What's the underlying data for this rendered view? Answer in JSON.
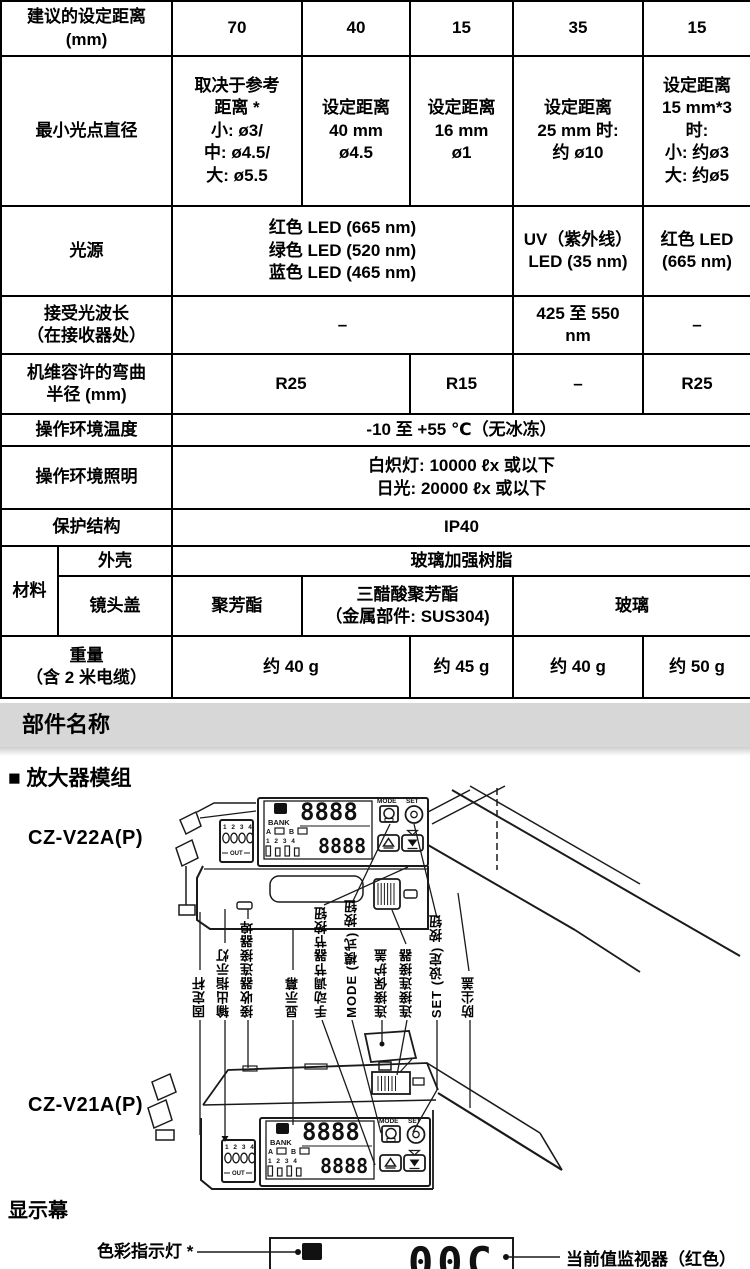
{
  "spec_table": {
    "rows": [
      {
        "cells": [
          {
            "t": "建议的设定距离\n(mm)"
          },
          {
            "t": "70"
          },
          {
            "t": "40"
          },
          {
            "t": "15"
          },
          {
            "t": "35"
          },
          {
            "t": "15"
          }
        ]
      },
      {
        "cells": [
          {
            "t": "最小光点直径"
          },
          {
            "t": "取决于参考\n距离 *\n小: ø3/\n中: ø4.5/\n大: ø5.5"
          },
          {
            "t": "设定距离\n40 mm\nø4.5"
          },
          {
            "t": "设定距离\n16 mm\nø1"
          },
          {
            "t": "设定距离\n25 mm 时:\n约 ø10"
          },
          {
            "t": "设定距离\n15 mm*3\n时:\n小: 约ø3\n大: 约ø5"
          }
        ]
      },
      {
        "cells": [
          {
            "t": "光源"
          },
          {
            "t": "红色 LED (665 nm)\n绿色 LED (520 nm)\n蓝色 LED (465 nm)"
          },
          {
            "t": "UV（紫外线）\nLED (35 nm)"
          },
          {
            "t": "红色 LED\n(665 nm)"
          }
        ]
      },
      {
        "cells": [
          {
            "t": "接受光波长\n（在接收器处）"
          },
          {
            "t": "–"
          },
          {
            "t": "425 至 550\nnm"
          },
          {
            "t": "–"
          }
        ]
      },
      {
        "cells": [
          {
            "t": "机维容许的弯曲\n半径 (mm)"
          },
          {
            "t": "R25"
          },
          {
            "t": "R15"
          },
          {
            "t": "–"
          },
          {
            "t": "R25"
          }
        ]
      },
      {
        "cells": [
          {
            "t": "操作环境温度"
          },
          {
            "t": "-10 至 +55 ℃（无冰冻）"
          }
        ]
      },
      {
        "cells": [
          {
            "t": "操作环境照明"
          },
          {
            "t": "白炽灯: 10000 ℓx 或以下\n日光: 20000 ℓx 或以下"
          }
        ]
      },
      {
        "cells": [
          {
            "t": "保护结构"
          },
          {
            "t": "IP40"
          }
        ]
      },
      {
        "cells": [
          {
            "t": "材料"
          },
          {
            "t": "外壳"
          },
          {
            "t": "玻璃加强树脂"
          }
        ]
      },
      {
        "cells": [
          {
            "t": "镜头盖"
          },
          {
            "t": "聚芳酯"
          },
          {
            "t": "三醋酸聚芳酯\n（金属部件: SUS304)"
          },
          {
            "t": "玻璃"
          }
        ]
      },
      {
        "cells": [
          {
            "t": "重量\n（含 2 米电缆）"
          },
          {
            "t": "约 40 g"
          },
          {
            "t": "约 45 g"
          },
          {
            "t": "约 40 g"
          },
          {
            "t": "约 50 g"
          }
        ]
      }
    ]
  },
  "parts_section": {
    "banner": "部件名称",
    "amplifier_heading": "■ 放大器模组",
    "model_top": "CZ-V22A(P)",
    "model_bottom": "CZ-V21A(P)",
    "labels": [
      "固定杆",
      "输出指示灯",
      "接收器连接器埠",
      "显示幕",
      "手动调节器节按钮",
      "MODE (模式) 按钮",
      "连接保护盖",
      "连接连接器",
      "SET (设定) 按钮",
      "防尘盖"
    ]
  },
  "amp_panel": {
    "c_badge": "C",
    "digits_top": "8888",
    "digits_bottom": "8888",
    "mode": "MODE",
    "set": "SET",
    "bank": "BANK",
    "a": "A",
    "b": "B",
    "bank_nums": "1 2 3 4",
    "out_nums": "1 2 3 4",
    "out": "OUT"
  },
  "display_section": {
    "heading": "显示幕",
    "color_indicator_label": "色彩指示灯 *",
    "current_value_label": "当前值监视器（红色）",
    "c_badge": "C",
    "digits": "00C"
  },
  "colors": {
    "banner_bg": "#d7d7d7",
    "line": "#1a1a1a"
  }
}
